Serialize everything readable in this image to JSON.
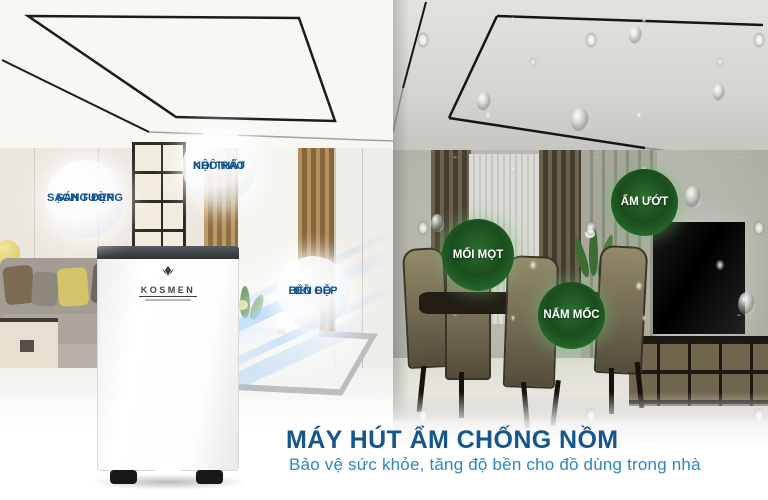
{
  "scene": {
    "dry_badges": [
      {
        "line1": "SẠCH TƯỜNG",
        "line2": "SÁNG ĐẸP"
      },
      {
        "line1": "NỘI THẤT",
        "line2": "KHÔ RÁO"
      },
      {
        "line1": "ĐỒ GỖ",
        "line2": "BỀN ĐẸP"
      }
    ],
    "humid_badges": [
      {
        "label": "MỐI MỌT"
      },
      {
        "label": "ẨM ƯỚT"
      },
      {
        "label": "NẤM MỐC"
      }
    ]
  },
  "product": {
    "brand": "KOSMEN"
  },
  "caption": {
    "title": "MÁY HÚT ẨM CHỐNG NỒM",
    "subtitle": "Bảo vệ sức khỏe, tăng độ bền cho đồ dùng trong nhà"
  },
  "colors": {
    "title_text": "#15568F",
    "subtitle_text": "#2E86C1",
    "dry_badge_text": "#10518D",
    "humid_badge_green": "#1C5220",
    "airflow_blue": "#A5CDF8"
  }
}
